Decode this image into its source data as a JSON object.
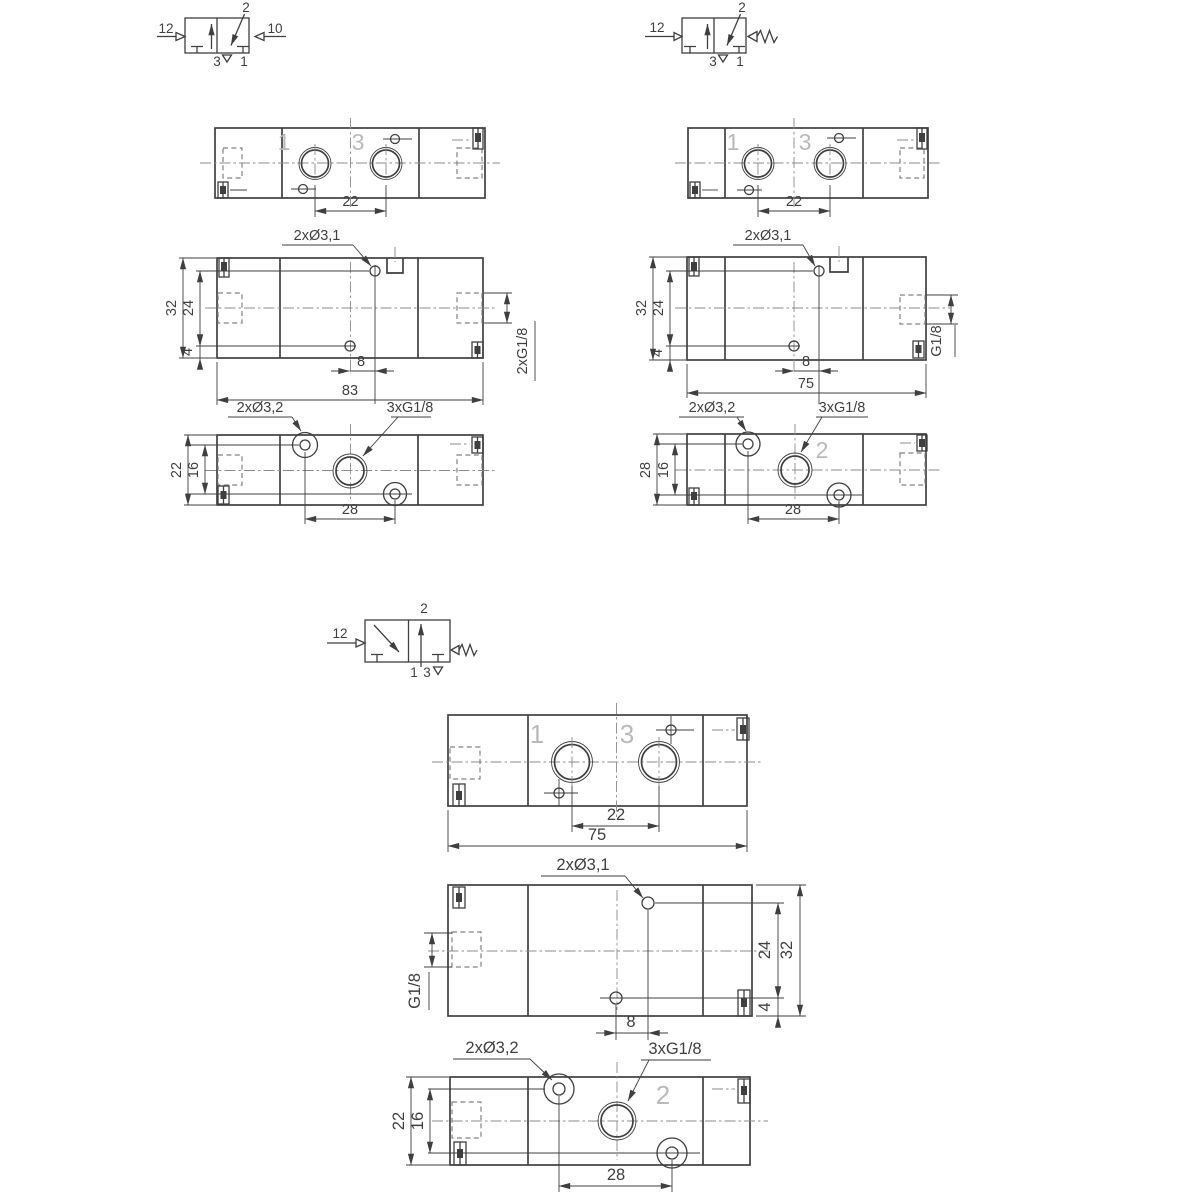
{
  "colors": {
    "line": "#3f3f3f",
    "centerline": "#8b8b8b",
    "hidden_line": "#828282",
    "port_number": "#b9b9b9",
    "background": "#ffffff"
  },
  "valve_a": {
    "symbol": {
      "pilot_left": "12",
      "pilot_right": "10",
      "port_top": "2",
      "port_exhaust": "3",
      "port_inlet": "1"
    },
    "top_view": {
      "port_1": "1",
      "port_3": "3",
      "dim_port_spacing": "22"
    },
    "front_view": {
      "label_holes": "2xØ3,1",
      "dim_height": "32",
      "dim_hole_top": "24",
      "dim_hole_bottom": "4",
      "dim_hole_offset": "8",
      "dim_width": "83",
      "label_side_ports": "2xG1/8"
    },
    "bottom_view": {
      "label_holes": "2xØ3,2",
      "label_ports": "3xG1/8",
      "dim_depth": "22",
      "dim_hole_rows": "16",
      "dim_hole_spacing": "28"
    }
  },
  "valve_b": {
    "symbol": {
      "pilot_left": "12",
      "port_top": "2",
      "port_exhaust": "3",
      "port_inlet": "1"
    },
    "top_view": {
      "port_1": "1",
      "port_3": "3",
      "dim_port_spacing": "22"
    },
    "front_view": {
      "label_holes": "2xØ3,1",
      "dim_height": "32",
      "dim_hole_top": "24",
      "dim_hole_bottom": "4",
      "dim_hole_offset": "8",
      "dim_width": "75",
      "label_side_port": "G1/8"
    },
    "bottom_view": {
      "label_holes": "2xØ3,2",
      "label_ports": "3xG1/8",
      "port_2": "2",
      "dim_depth": "28",
      "dim_hole_rows": "16",
      "dim_hole_spacing": "28"
    }
  },
  "valve_c": {
    "symbol": {
      "pilot_left": "12",
      "port_top": "2",
      "port_1": "1",
      "port_3": "3"
    },
    "top_view": {
      "port_1": "1",
      "port_3": "3",
      "dim_port_spacing": "22",
      "dim_width": "75"
    },
    "front_view": {
      "label_holes": "2xØ3,1",
      "label_side_port": "G1/8",
      "dim_hole_top": "24",
      "dim_height": "32",
      "dim_hole_bottom": "4",
      "dim_hole_offset": "8"
    },
    "bottom_view": {
      "label_holes": "2xØ3,2",
      "label_ports": "3xG1/8",
      "port_2": "2",
      "dim_depth": "22",
      "dim_hole_rows": "16",
      "dim_hole_spacing": "28"
    }
  }
}
